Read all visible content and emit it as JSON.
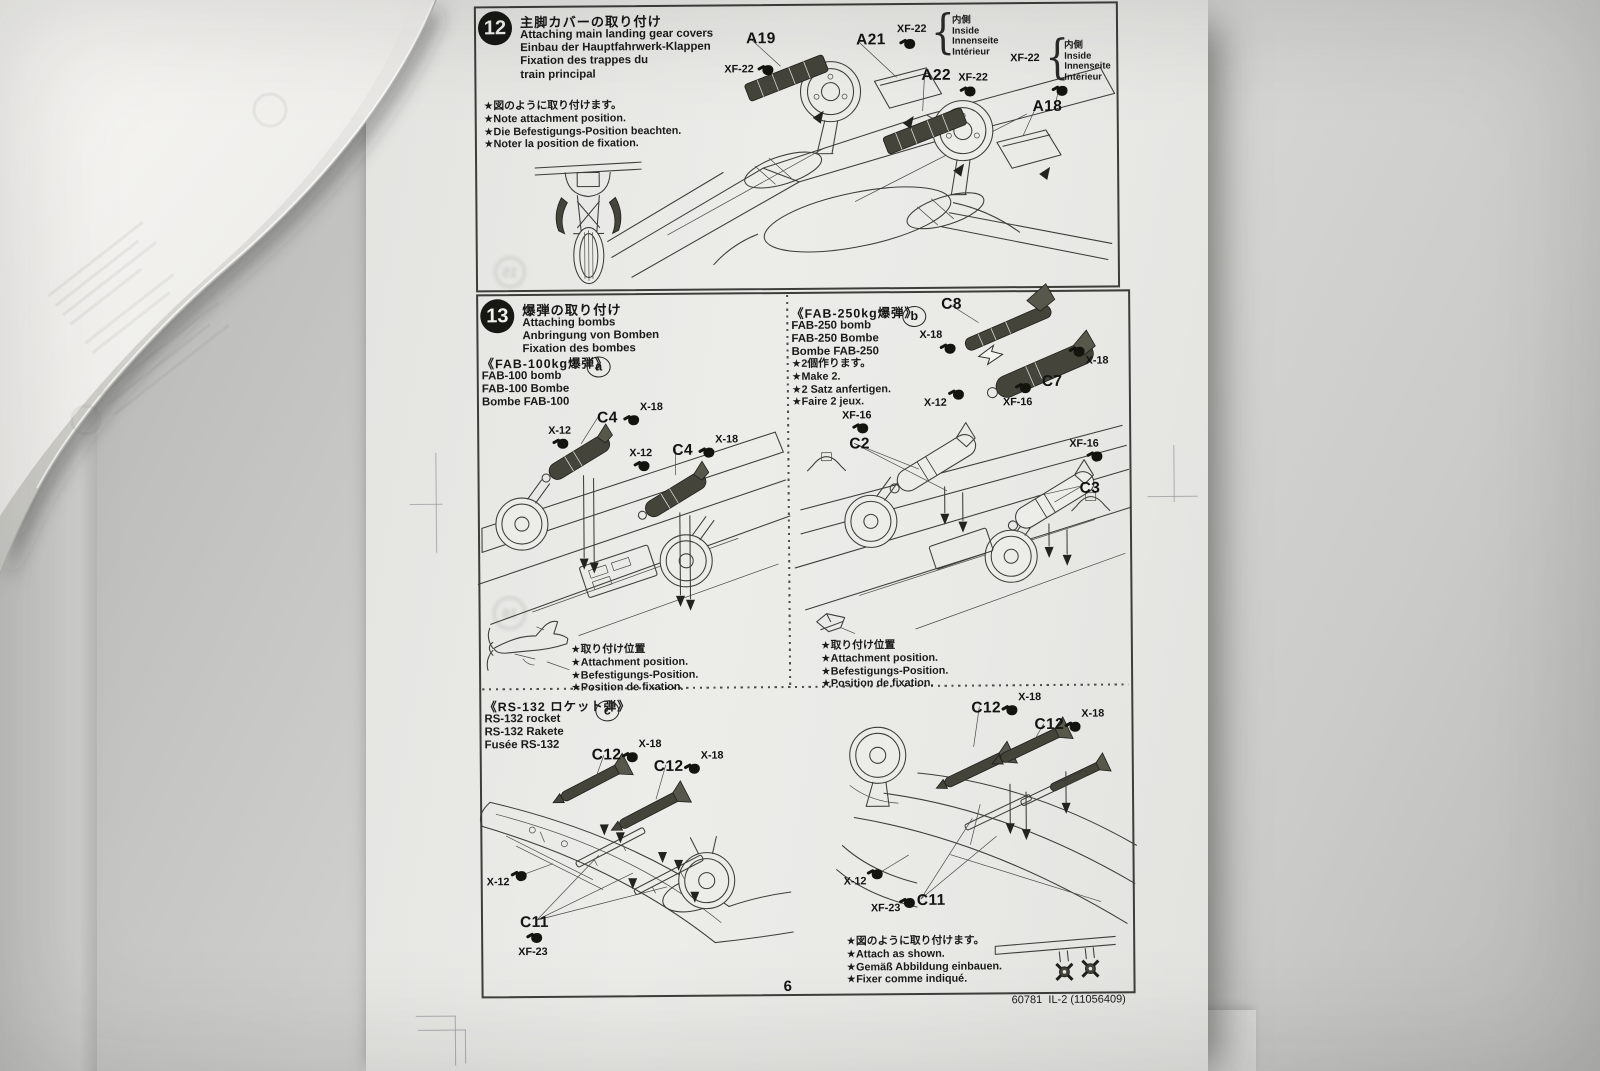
{
  "paints": {
    "xf22": "XF-22",
    "x18": "X-18",
    "x12": "X-12",
    "xf16": "XF-16",
    "xf23": "XF-23"
  },
  "parts": {
    "a19": "A19",
    "a21": "A21",
    "a22": "A22",
    "a18": "A18",
    "c4": "C4",
    "c8": "C8",
    "c7": "C7",
    "c2": "C2",
    "c3": "C3",
    "c12": "C12",
    "c11": "C11"
  },
  "step12": {
    "number": "12",
    "title_jp": "主脚カバーの取り付け",
    "titles": [
      "Attaching main landing gear covers",
      "Einbau der Hauptfahrwerk-Klappen",
      "Fixation des trappes du",
      "train principal"
    ],
    "notes": [
      "★図のように取り付けます。",
      "★Note attachment position.",
      "★Die Befestigungs-Position beachten.",
      "★Noter la position de fixation."
    ],
    "inside": [
      "内側",
      "Inside",
      "Innenseite",
      "Intérieur"
    ]
  },
  "step13": {
    "number": "13",
    "title_jp": "爆弾の取り付け",
    "titles": [
      "Attaching bombs",
      "Anbringung von Bomben",
      "Fixation des bombes"
    ],
    "attach_notes": [
      "★取り付け位置",
      "★Attachment position.",
      "★Befestigungs-Position.",
      "★Position de fixation."
    ],
    "section_a": {
      "title_jp": "《FAB-100kg爆弾》",
      "badge": "a",
      "lines": [
        "FAB-100 bomb",
        "FAB-100 Bombe",
        "Bombe FAB-100"
      ]
    },
    "section_b": {
      "title_jp": "《FAB-250kg爆弾》",
      "badge": "b",
      "lines": [
        "FAB-250 bomb",
        "FAB-250 Bombe",
        "Bombe FAB-250"
      ],
      "make_notes": [
        "★2個作ります。",
        "★Make 2.",
        "★2 Satz anfertigen.",
        "★Faire 2 jeux."
      ]
    },
    "section_c": {
      "title_jp": "《RS-132 ロケット弾》",
      "badge": "c",
      "lines": [
        "RS-132 rocket",
        "RS-132 Rakete",
        "Fusée RS-132"
      ],
      "final_notes": [
        "★図のように取り付けます。",
        "★Attach as shown.",
        "★Gemäß Abbildung einbauen.",
        "★Fixer comme indiqué."
      ]
    }
  },
  "footer": {
    "page_number": "6",
    "product_code": "60781  IL-2 (11056409)"
  },
  "ghost": {
    "n15": "15",
    "n16": "16"
  }
}
